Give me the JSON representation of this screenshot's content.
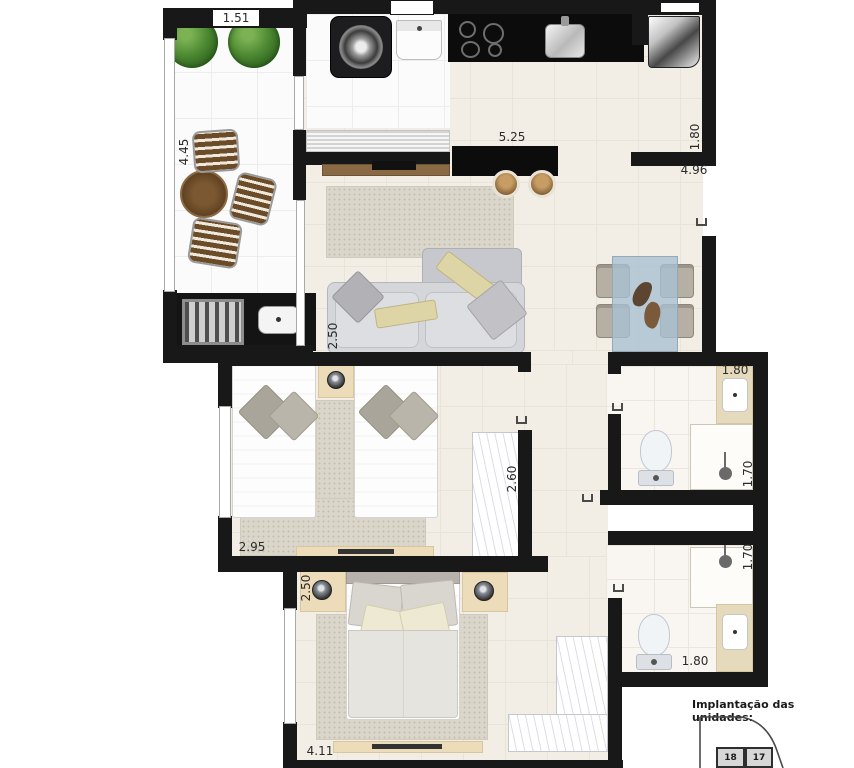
{
  "plan": {
    "dims": {
      "balcony_opening": "1.51",
      "balcony_length": "4.45",
      "counter_length": "5.25",
      "entry_width": "1.80",
      "living_length": "4.96",
      "living_width": "2.50",
      "bedroom1_width": "2.95",
      "bedroom1_closet_width": "2.60",
      "bath1_width": "1.80",
      "bath1_shower_width": "1.70",
      "bath2_shower_width": "1.70",
      "bath2_width": "1.80",
      "bedroom2_depth": "2.50",
      "bedroom2_width": "4.11"
    },
    "inset": {
      "title": "Implantação das unidades:",
      "units": [
        {
          "label": "18"
        },
        {
          "label": "17"
        }
      ]
    }
  }
}
